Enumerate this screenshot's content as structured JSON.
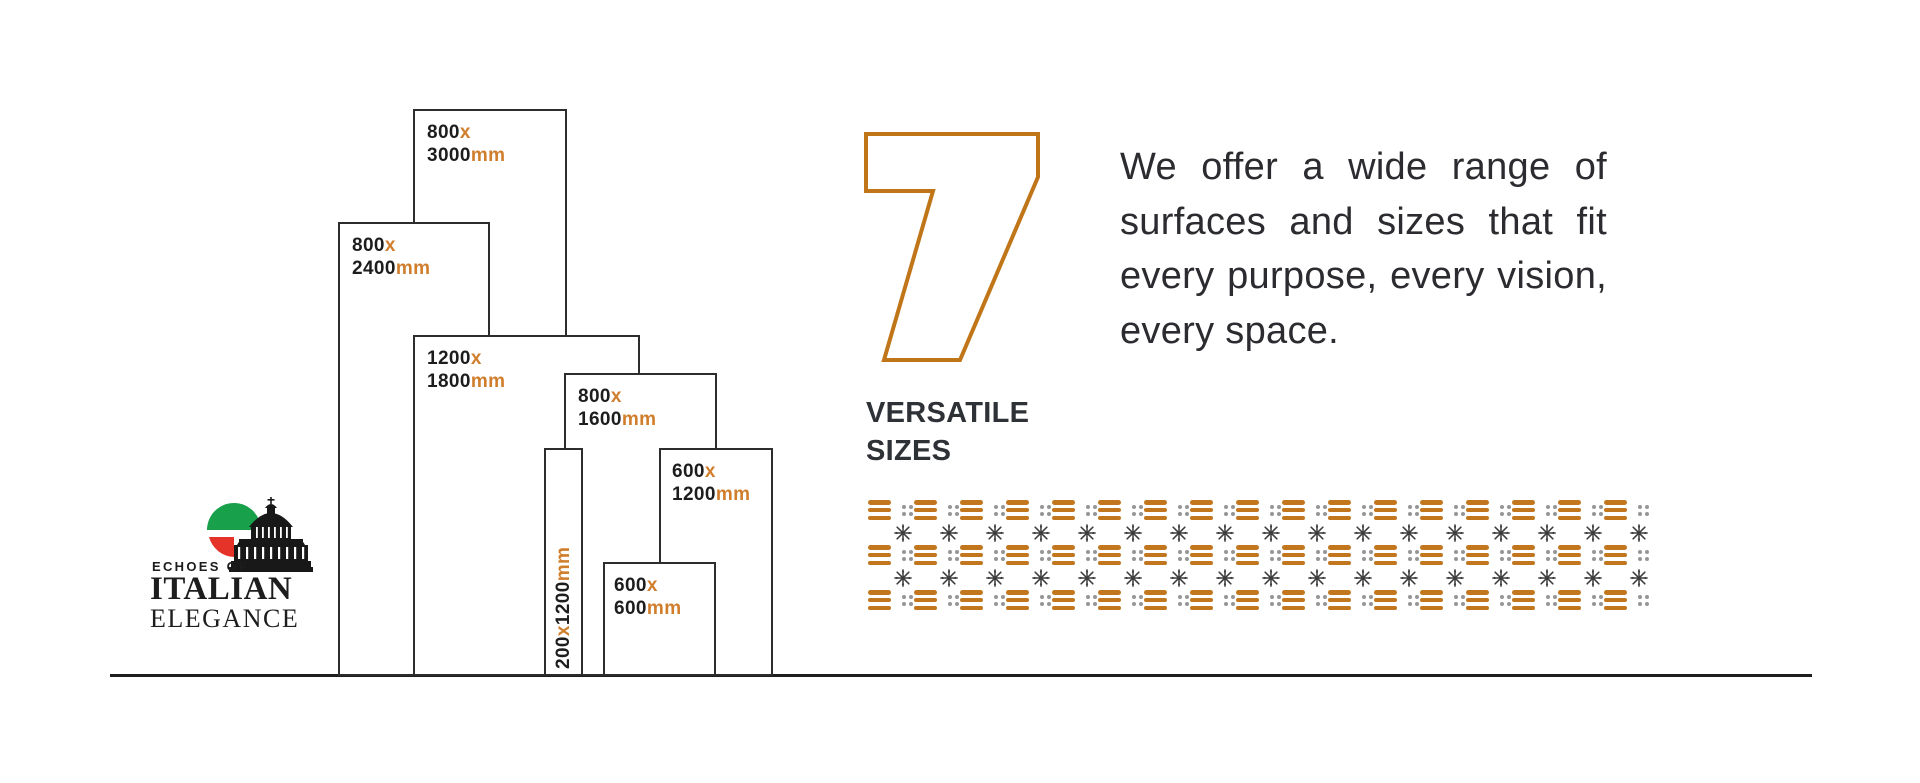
{
  "logo": {
    "echoes_of": "ECHOES OF",
    "italian": "ITALIAN",
    "elegance": "ELEGANCE",
    "icon": "italian-flag-basilica-dome-icon",
    "flag_green": "#18A04A",
    "flag_red": "#E63329",
    "dome_color": "#181818"
  },
  "headline": {
    "number": "7",
    "line1": "VERSATILE",
    "line2": "SIZES"
  },
  "paragraph": {
    "lines": [
      "We offer a wide range of",
      "surfaces and sizes that fit",
      "every purpose, every vision,",
      "every space."
    ]
  },
  "chart_data": {
    "type": "bar",
    "title": "7 Versatile Sizes",
    "unit": "mm",
    "categories": [
      "800×3000",
      "800×2400",
      "1200×1800",
      "800×1600",
      "200×1200",
      "600×1200",
      "600×600"
    ],
    "values_width_mm": [
      800,
      800,
      1200,
      800,
      200,
      600,
      600
    ],
    "values_height_mm": [
      3000,
      2400,
      1800,
      1600,
      1200,
      1200,
      600
    ],
    "layout": "proportional skyline, bars outlined, sitting on common baseline",
    "sizes": [
      {
        "w": "800",
        "sep": "x",
        "h": "3000",
        "unit": "mm"
      },
      {
        "w": "800",
        "sep": "x",
        "h": "2400",
        "unit": "mm"
      },
      {
        "w": "1200",
        "sep": "x",
        "h": "1800",
        "unit": "mm"
      },
      {
        "w": "800",
        "sep": "x",
        "h": "1600",
        "unit": "mm"
      },
      {
        "w": "200",
        "sep": "x",
        "h": "1200",
        "unit": "mm"
      },
      {
        "w": "600",
        "sep": "x",
        "h": "1200",
        "unit": "mm"
      },
      {
        "w": "600",
        "sep": "x",
        "h": "600",
        "unit": "mm"
      }
    ]
  },
  "pattern": {
    "columns": 17,
    "rows": [
      "bars-dots",
      "flakes",
      "bars-dots",
      "flakes",
      "bars-dots"
    ],
    "motifs": [
      "triple-bar-motif",
      "quad-dot-motif",
      "snowflake-motif"
    ]
  },
  "colors": {
    "pattern_orange": "#C2771E",
    "label_accent": "#D07E2C",
    "seven_outline": "#C07618",
    "text_dark": "#1d1d1d",
    "bar_outline": "#2d2d2d",
    "flake_gray": "#3d3d3d",
    "dot_gray": "#969696"
  }
}
